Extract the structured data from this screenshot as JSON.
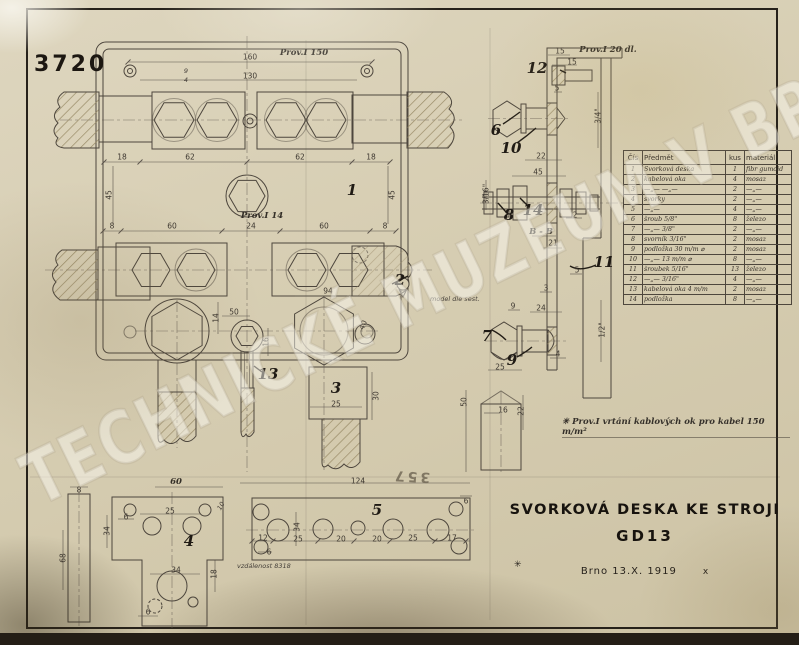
{
  "page": {
    "watermark": "TECHNICKÉ MUZEUM V BRNĚ"
  },
  "drawing": {
    "number": "3720",
    "title_line1": "SVORKOVÁ DESKA KE STROJI",
    "title_line2": "GD13",
    "title_star": "✳",
    "place_date": "Brno  13.X. 1919",
    "date_mark": "x",
    "footnote": "✳ Prov.I  vrtání kablových ok pro kabel 150 m/m²",
    "stamp_reversed": "357"
  },
  "parts_table": {
    "headers": [
      "Čís",
      "Předmět",
      "kus",
      "materiál"
    ],
    "rows": [
      [
        "1",
        "Svorková deska",
        "1",
        "fibr gumoid"
      ],
      [
        "2",
        "kabelová oka",
        "4",
        "mosaz"
      ],
      [
        "3",
        "—„—  —„—",
        "2",
        "—„—"
      ],
      [
        "4",
        "svorky",
        "2",
        "—„—"
      ],
      [
        "5",
        "—„—",
        "4",
        "—„—"
      ],
      [
        "6",
        "šroub 5/8\"",
        "8",
        "železo"
      ],
      [
        "7",
        "—„— 3/8\"",
        "2",
        "—„—"
      ],
      [
        "8",
        "svorník 3/16\"",
        "2",
        "mosaz"
      ],
      [
        "9",
        "podložka 30 m/m ⌀",
        "2",
        "mosaz"
      ],
      [
        "10",
        "—„— 13 m/m ⌀",
        "8",
        "—„—"
      ],
      [
        "11",
        "šroubek 5/16\"",
        "13",
        "železo"
      ],
      [
        "12",
        "—„— 3/16\"",
        "4",
        "—„—"
      ],
      [
        "13",
        "kabelová oka 4 m/m",
        "2",
        "mosaz"
      ],
      [
        "14",
        "podložka",
        "8",
        "—„—"
      ]
    ]
  },
  "annotations": [
    {
      "t": "160",
      "x": 250,
      "y": 57
    },
    {
      "t": "Prov.I 150",
      "x": 304,
      "y": 53,
      "c": "hand",
      "n": "note-prov-150"
    },
    {
      "t": "130",
      "x": 250,
      "y": 76
    },
    {
      "t": "9",
      "x": 186,
      "y": 71,
      "c": "tiny"
    },
    {
      "t": "4",
      "x": 186,
      "y": 80,
      "c": "tiny"
    },
    {
      "t": "18",
      "x": 122,
      "y": 157
    },
    {
      "t": "62",
      "x": 190,
      "y": 157
    },
    {
      "t": "62",
      "x": 300,
      "y": 157
    },
    {
      "t": "18",
      "x": 371,
      "y": 157
    },
    {
      "t": "45",
      "x": 109,
      "y": 195,
      "r": -90
    },
    {
      "t": "45",
      "x": 392,
      "y": 195,
      "r": -90
    },
    {
      "t": "8",
      "x": 112,
      "y": 226
    },
    {
      "t": "60",
      "x": 172,
      "y": 226
    },
    {
      "t": "24",
      "x": 251,
      "y": 226
    },
    {
      "t": "60",
      "x": 324,
      "y": 226
    },
    {
      "t": "8",
      "x": 385,
      "y": 226
    },
    {
      "t": "Prov.I 14",
      "x": 262,
      "y": 216,
      "c": "hand",
      "n": "note-prov-14"
    },
    {
      "t": "1",
      "x": 352,
      "y": 190,
      "c": "part",
      "n": "part-label-1"
    },
    {
      "t": "94",
      "x": 328,
      "y": 291
    },
    {
      "t": "50",
      "x": 234,
      "y": 312
    },
    {
      "t": "14",
      "x": 216,
      "y": 318,
      "r": -90
    },
    {
      "t": "16",
      "x": 266,
      "y": 342,
      "r": -90
    },
    {
      "t": "40",
      "x": 363,
      "y": 325,
      "r": -65
    },
    {
      "t": "2",
      "x": 400,
      "y": 280,
      "c": "part",
      "n": "part-label-2"
    },
    {
      "t": "model dle sest.",
      "x": 430,
      "y": 299,
      "c": "tiny",
      "a": "l",
      "n": "note-model"
    },
    {
      "t": "13",
      "x": 268,
      "y": 374,
      "c": "part",
      "n": "part-label-13"
    },
    {
      "t": "3",
      "x": 336,
      "y": 388,
      "c": "part",
      "n": "part-label-3"
    },
    {
      "t": "25",
      "x": 336,
      "y": 404
    },
    {
      "t": "30",
      "x": 376,
      "y": 396,
      "r": -90
    },
    {
      "t": "15",
      "x": 560,
      "y": 51
    },
    {
      "t": "Prov.I 20 dl.",
      "x": 608,
      "y": 50,
      "c": "hand",
      "n": "note-prov-20"
    },
    {
      "t": "15",
      "x": 572,
      "y": 62
    },
    {
      "t": "12",
      "x": 537,
      "y": 68,
      "c": "part",
      "n": "part-label-12"
    },
    {
      "t": "5",
      "x": 557,
      "y": 88
    },
    {
      "t": "3/4\"",
      "x": 598,
      "y": 116,
      "r": -90
    },
    {
      "t": "6",
      "x": 496,
      "y": 130,
      "c": "part",
      "n": "part-label-6"
    },
    {
      "t": "10",
      "x": 511,
      "y": 148,
      "c": "part",
      "n": "part-label-10"
    },
    {
      "t": "22",
      "x": 541,
      "y": 156
    },
    {
      "t": "45",
      "x": 538,
      "y": 172
    },
    {
      "t": "3/16\"",
      "x": 486,
      "y": 194,
      "r": -90
    },
    {
      "t": "8",
      "x": 509,
      "y": 215,
      "c": "part",
      "n": "part-label-8"
    },
    {
      "t": "14",
      "x": 533,
      "y": 210,
      "c": "part",
      "n": "part-label-14"
    },
    {
      "t": "2",
      "x": 575,
      "y": 215
    },
    {
      "t": "B - B",
      "x": 541,
      "y": 232,
      "c": "hand",
      "n": "section-label-b-b"
    },
    {
      "t": "21",
      "x": 553,
      "y": 243
    },
    {
      "t": "11",
      "x": 604,
      "y": 262,
      "c": "part",
      "n": "part-label-11"
    },
    {
      "t": "5",
      "x": 577,
      "y": 270
    },
    {
      "t": "3",
      "x": 546,
      "y": 288
    },
    {
      "t": "24",
      "x": 541,
      "y": 308
    },
    {
      "t": "9",
      "x": 513,
      "y": 306
    },
    {
      "t": "7",
      "x": 487,
      "y": 336,
      "c": "part",
      "n": "part-label-7"
    },
    {
      "t": "9",
      "x": 512,
      "y": 360,
      "c": "part",
      "n": "part-label-9"
    },
    {
      "t": "4",
      "x": 558,
      "y": 354
    },
    {
      "t": "1/2\"",
      "x": 602,
      "y": 330,
      "r": -90
    },
    {
      "t": "25",
      "x": 500,
      "y": 367
    },
    {
      "t": "50",
      "x": 464,
      "y": 402,
      "r": -90
    },
    {
      "t": "16",
      "x": 503,
      "y": 410
    },
    {
      "t": "22",
      "x": 521,
      "y": 411,
      "r": -90
    },
    {
      "t": "60",
      "x": 176,
      "y": 482,
      "c": "hand"
    },
    {
      "t": "8",
      "x": 79,
      "y": 490
    },
    {
      "t": "68",
      "x": 63,
      "y": 558,
      "r": -90
    },
    {
      "t": "25",
      "x": 170,
      "y": 511
    },
    {
      "t": "6",
      "x": 126,
      "y": 517
    },
    {
      "t": "34",
      "x": 107,
      "y": 531,
      "r": -90
    },
    {
      "t": "10",
      "x": 221,
      "y": 506,
      "r": -60,
      "c": "tiny"
    },
    {
      "t": "4",
      "x": 189,
      "y": 541,
      "c": "part",
      "n": "part-label-4"
    },
    {
      "t": "34",
      "x": 176,
      "y": 570
    },
    {
      "t": "18",
      "x": 214,
      "y": 574,
      "r": -90
    },
    {
      "t": "6",
      "x": 148,
      "y": 612
    },
    {
      "t": "vzdálenost 8318",
      "x": 237,
      "y": 566,
      "c": "tiny",
      "a": "l",
      "n": "note-vzdalenost"
    },
    {
      "t": "124",
      "x": 358,
      "y": 481
    },
    {
      "t": "5",
      "x": 377,
      "y": 510,
      "c": "part",
      "n": "part-label-5"
    },
    {
      "t": "12",
      "x": 263,
      "y": 538
    },
    {
      "t": "25",
      "x": 298,
      "y": 539
    },
    {
      "t": "20",
      "x": 341,
      "y": 539
    },
    {
      "t": "20",
      "x": 377,
      "y": 539
    },
    {
      "t": "25",
      "x": 413,
      "y": 538
    },
    {
      "t": "17",
      "x": 452,
      "y": 538
    },
    {
      "t": "6",
      "x": 269,
      "y": 552
    },
    {
      "t": "6",
      "x": 466,
      "y": 501
    },
    {
      "t": "34",
      "x": 297,
      "y": 527,
      "r": -90
    }
  ]
}
